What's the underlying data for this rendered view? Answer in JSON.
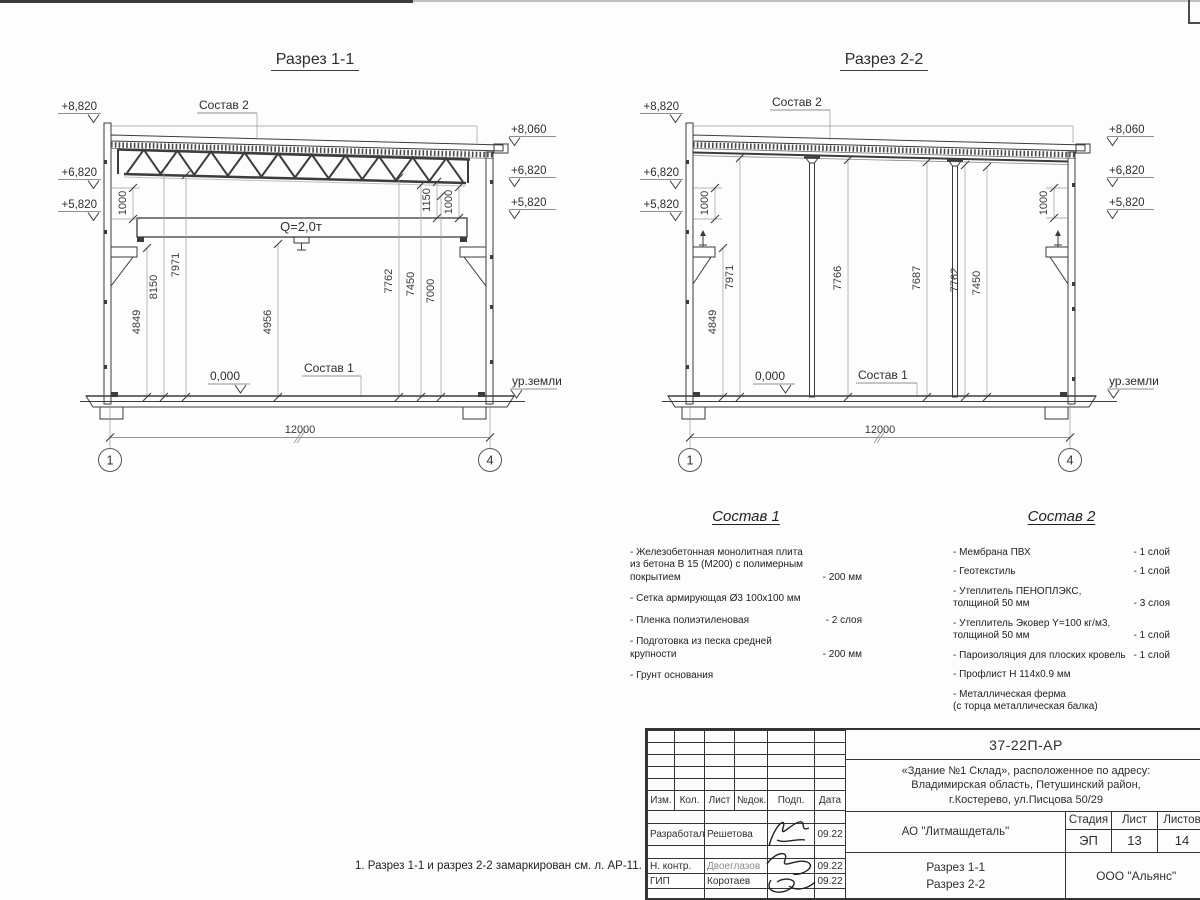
{
  "section1": {
    "title": "Разрез 1-1",
    "sostav2_ref": "Состав 2",
    "sostav1_ref": "Состав 1",
    "crane": "Q=2,0т",
    "zero": "0,000",
    "ground": "ур.земли",
    "span": "12000",
    "axis_left": "1",
    "axis_right": "4",
    "elev_left": [
      "+8,820",
      "+6,820",
      "+5,820"
    ],
    "elev_right": [
      "+8,060",
      "+6,820",
      "+5,820"
    ],
    "dim_left_small": "1000",
    "dims": [
      "4849",
      "8150",
      "7971",
      "4956",
      "7762",
      "7450",
      "7000"
    ],
    "dims_right_small": [
      "1150",
      "1000"
    ]
  },
  "section2": {
    "title": "Разрез 2-2",
    "sostav2_ref": "Состав 2",
    "sostav1_ref": "Состав 1",
    "zero": "0,000",
    "ground": "ур.земли",
    "span": "12000",
    "axis_left": "1",
    "axis_right": "4",
    "elev_left": [
      "+8,820",
      "+6,820",
      "+5,820"
    ],
    "elev_right": [
      "+8,060",
      "+6,820",
      "+5,820"
    ],
    "dim_left_small": "1000",
    "dim_right_small": "1000",
    "dims": [
      "4849",
      "7971",
      "7766",
      "7687",
      "7762",
      "7450"
    ]
  },
  "sostav1": {
    "title": "Состав 1",
    "items": [
      {
        "name": "- Железобетонная  монолитная плита\nиз бетона В 15 (М200) с полимерным\nпокрытием",
        "value": "- 200 мм"
      },
      {
        "name": "- Сетка армирующая Ø3 100х100 мм",
        "value": ""
      },
      {
        "name": "- Пленка полиэтиленовая",
        "value": "-  2 слоя"
      },
      {
        "name": "- Подготовка из песка средней\n  крупности",
        "value": "- 200 мм"
      },
      {
        "name": "- Грунт основания",
        "value": ""
      }
    ]
  },
  "sostav2": {
    "title": "Состав 2",
    "items": [
      {
        "name": "- Мембрана ПВХ",
        "value": "- 1 слой"
      },
      {
        "name": "- Геотекстиль",
        "value": "- 1 слой"
      },
      {
        "name": "- Утеплитель ПЕНОПЛЭКС,\n  толщиной 50 мм",
        "value": "- 3 слоя"
      },
      {
        "name": "- Утеплитель Эковер Y=100 кг/м3,\n  толщиной 50 мм",
        "value": "- 1 слой"
      },
      {
        "name": "- Пароизоляция для плоских кровель",
        "value": "- 1 слой"
      },
      {
        "name": "- Профлист Н 114х0.9 мм",
        "value": ""
      },
      {
        "name": "- Металлическая ферма\n(с торца металлическая балка)",
        "value": ""
      }
    ]
  },
  "note": "1. Разрез 1-1 и разрез 2-2 замаркирован см. л. АР-11.",
  "titleblock": {
    "doc_number": "37-22П-АР",
    "address_line1": "«Здание №1 Склад», расположенное по адресу:",
    "address_line2": "Владимирская область, Петушинский район,",
    "address_line3": "г.Костерево, ул.Писцова 50/29",
    "col_izm": "Изм.",
    "col_kol": "Кол.",
    "col_list": "Лист",
    "col_ndok": "№док.",
    "col_podp": "Подп.",
    "col_data": "Дата",
    "rows": [
      {
        "role": "Разработал",
        "name": "Решетова",
        "date": "09.22"
      },
      {
        "role": "Н. контр.",
        "name": "Двоеглазов",
        "date": "09.22"
      },
      {
        "role": "ГИП",
        "name": "Коротаев",
        "date": "09.22"
      }
    ],
    "company": "АО \"Литмашдеталь\"",
    "stage_label": "Стадия",
    "sheet_label": "Лист",
    "sheets_label": "Листов",
    "stage": "ЭП",
    "sheet": "13",
    "sheets": "14",
    "subject_line1": "Разрез 1-1",
    "subject_line2": "Разрез 2-2",
    "contractor": "ООО \"Альянс\""
  }
}
